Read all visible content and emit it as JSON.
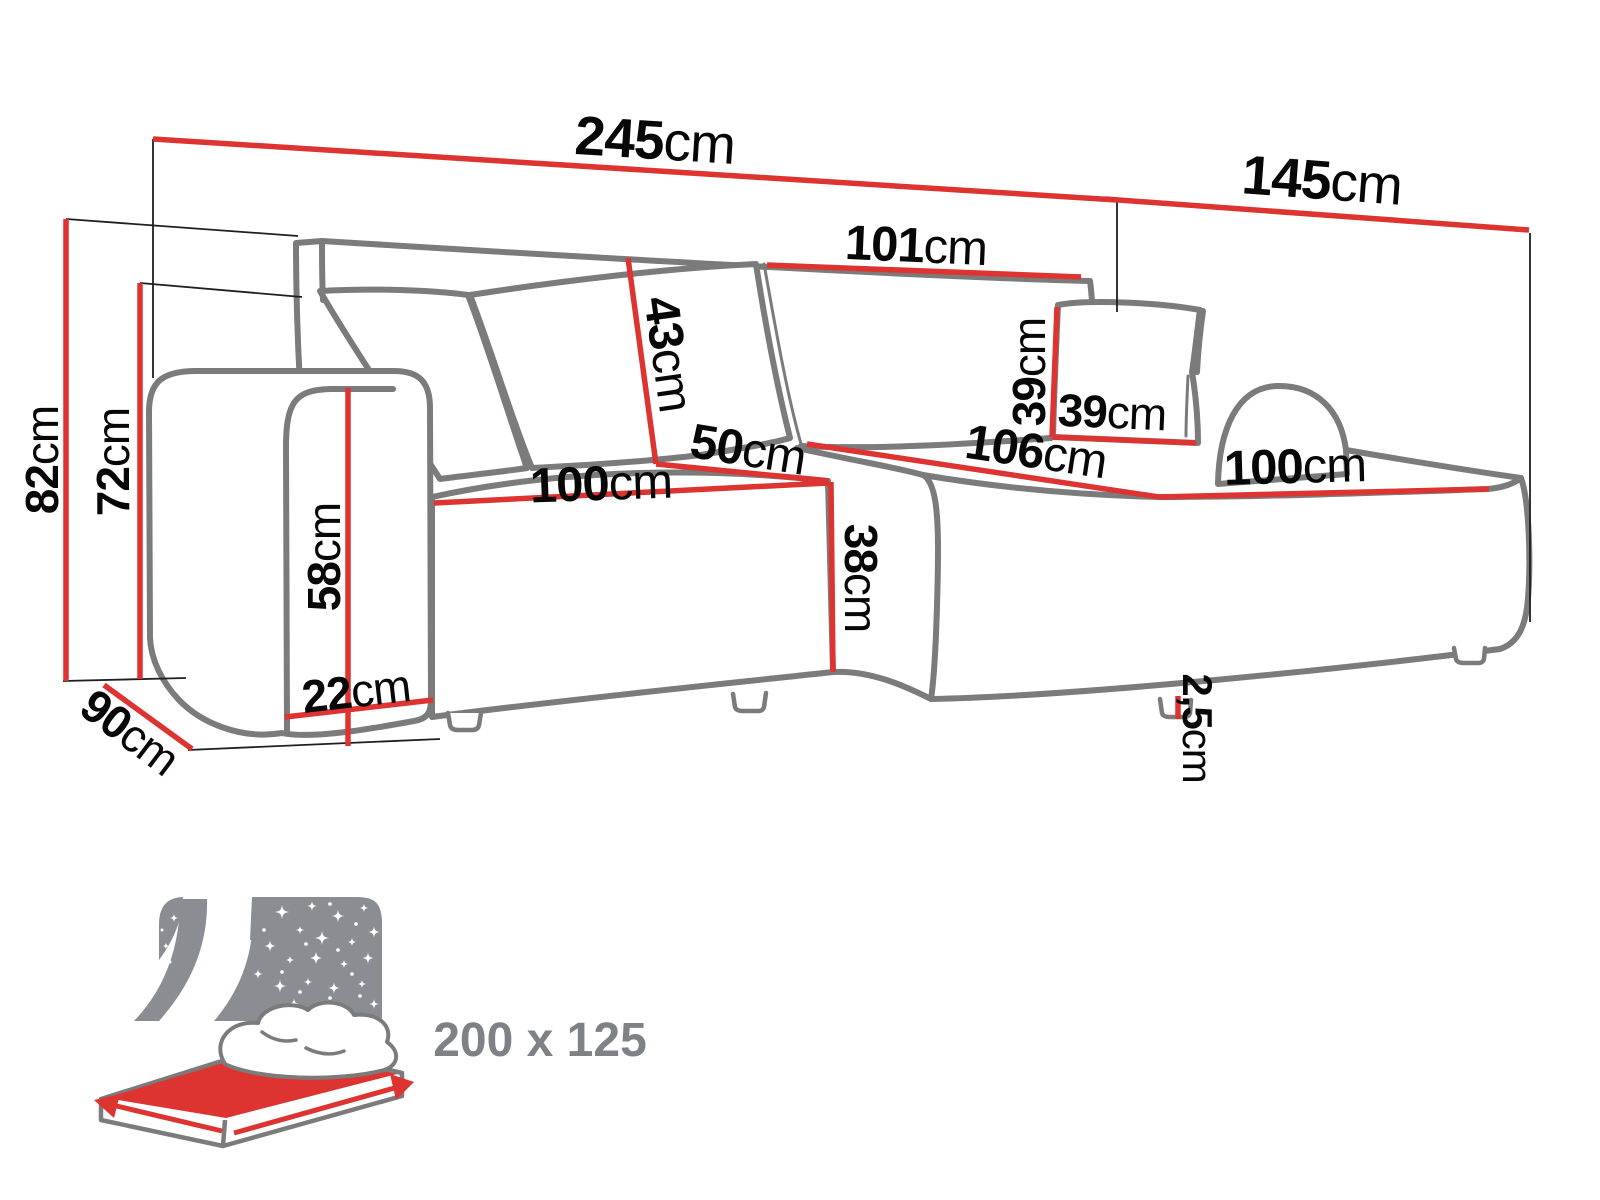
{
  "title": "Corner sofa dimensions diagram",
  "dimensions": {
    "total_width": {
      "value": "245",
      "unit": "cm"
    },
    "side_depth": {
      "value": "145",
      "unit": "cm"
    },
    "back_section_width": {
      "value": "101",
      "unit": "cm"
    },
    "backrest_height": {
      "value": "43",
      "unit": "cm"
    },
    "corner_width": {
      "value": "50",
      "unit": "cm"
    },
    "left_seat_width": {
      "value": "100",
      "unit": "cm"
    },
    "chaise_length": {
      "value": "106",
      "unit": "cm"
    },
    "chaise_seat_width": {
      "value": "100",
      "unit": "cm"
    },
    "cushion_height": {
      "value": "39",
      "unit": "cm"
    },
    "cushion_width": {
      "value": "39",
      "unit": "cm"
    },
    "total_height": {
      "value": "82",
      "unit": "cm"
    },
    "backrest_top_height": {
      "value": "72",
      "unit": "cm"
    },
    "armrest_height": {
      "value": "58",
      "unit": "cm"
    },
    "armrest_width": {
      "value": "22",
      "unit": "cm"
    },
    "seat_height": {
      "value": "38",
      "unit": "cm"
    },
    "side_width": {
      "value": "90",
      "unit": "cm"
    },
    "leg_height": {
      "value": "2,5",
      "unit": "cm"
    }
  },
  "sleeping_area": {
    "label": "200 x 125"
  },
  "colors": {
    "dimension_red": "#de3431",
    "outline_gray": "#7b7b7b",
    "label_black": "#070707",
    "icon_gray": "#8a8e92"
  }
}
